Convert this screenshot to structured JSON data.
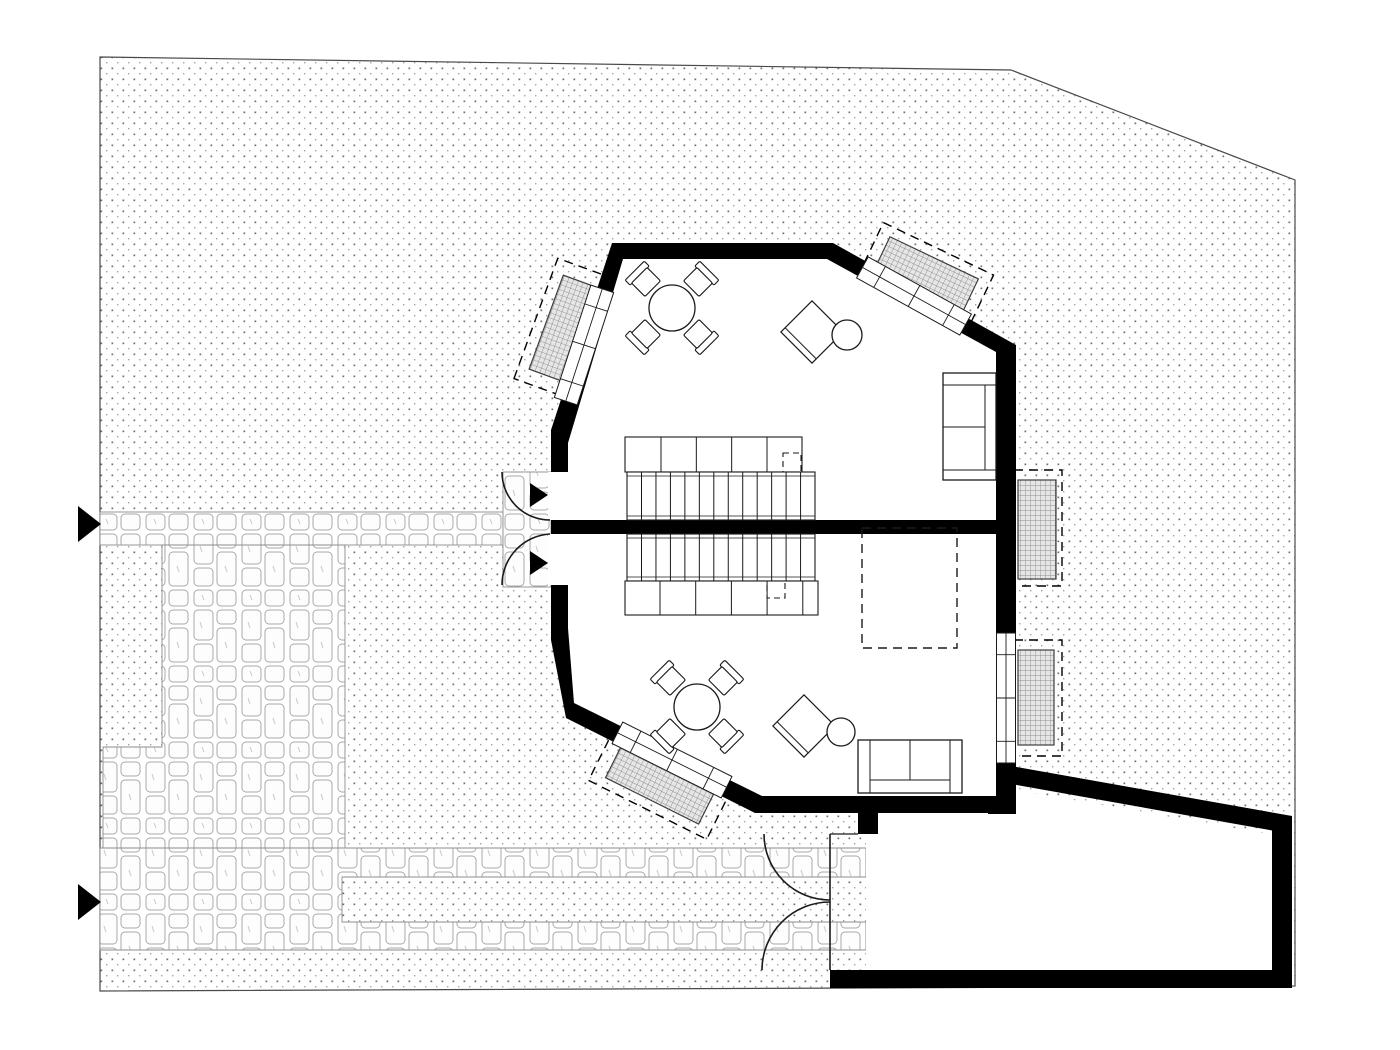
{
  "document": {
    "kind": "architectural-site-and-floor-plan",
    "canvas": {
      "width": 1400,
      "height": 1050,
      "background": "#ffffff"
    }
  },
  "colors": {
    "wall": "#000000",
    "line": "#1a1a1a",
    "white": "#ffffff",
    "site_edge": "#4a4a4a",
    "paving_edge": "#8c8c8c",
    "grate_edge": "#3c3c3c"
  },
  "defaults": {
    "stroke": "#1a1a1a",
    "sw": 1.2
  },
  "elements": [
    {
      "name": "site-parcel",
      "type": "polygon",
      "pts": [
        [
          100,
          57
        ],
        [
          1011,
          70
        ],
        [
          1295,
          180
        ],
        [
          1295,
          986
        ],
        [
          866,
          988
        ],
        [
          100,
          991
        ]
      ],
      "fill": "url(#stipple)",
      "stroke": "@site_edge",
      "sw": 1.2
    },
    {
      "name": "paving-walkway-upper",
      "type": "rect",
      "x": 100,
      "y": 512,
      "w": 403,
      "h": 33,
      "fill": "url(#stone)",
      "stroke": "@paving_edge",
      "sw": 0.9
    },
    {
      "name": "paving-entry-pad",
      "type": "rect",
      "x": 503,
      "y": 472,
      "w": 48,
      "h": 115,
      "fill": "url(#stone)",
      "stroke": "@paving_edge",
      "sw": 0.9
    },
    {
      "name": "paving-courtyard",
      "type": "polygon",
      "pts": [
        [
          162,
          545
        ],
        [
          345,
          545
        ],
        [
          345,
          848
        ],
        [
          103,
          848
        ],
        [
          103,
          747
        ],
        [
          162,
          747
        ]
      ],
      "fill": "url(#stone)",
      "stroke": "@paving_edge",
      "sw": 0.9
    },
    {
      "name": "paving-walkway-lower",
      "type": "polygon",
      "pts": [
        [
          100,
          848
        ],
        [
          866,
          848
        ],
        [
          866,
          877
        ],
        [
          342,
          877
        ],
        [
          342,
          922
        ],
        [
          866,
          922
        ],
        [
          866,
          950
        ],
        [
          100,
          950
        ]
      ],
      "fill": "url(#stone)",
      "stroke": "@paving_edge",
      "sw": 0.9
    },
    {
      "name": "lightwell-topleft-dashed-outline",
      "type": "rect",
      "x": 501,
      "y": 298,
      "w": 128,
      "h": 62,
      "rot": -70,
      "fill": "none",
      "stroke": "@wall",
      "sw": 1.4,
      "dash": "9 6"
    },
    {
      "name": "lightwell-topleft-grate",
      "type": "rect",
      "x": 515,
      "y": 309,
      "w": 100,
      "h": 40,
      "rot": -70,
      "fill": "url(#grate)",
      "stroke": "@grate_edge",
      "sw": 1.2
    },
    {
      "name": "lightwell-topright-dashed-outline",
      "type": "rect",
      "x": 865,
      "y": 246,
      "w": 122,
      "h": 58,
      "rot": 25.5,
      "fill": "none",
      "stroke": "@wall",
      "sw": 1.4,
      "dash": "9 6"
    },
    {
      "name": "lightwell-topright-grate",
      "type": "rect",
      "x": 877,
      "y": 256,
      "w": 98,
      "h": 38,
      "rot": 25.5,
      "fill": "url(#grate)",
      "stroke": "@grate_edge",
      "sw": 1.2
    },
    {
      "name": "lightwell-right-upper-dashed-outline",
      "type": "rect",
      "x": 1014,
      "y": 470,
      "w": 48,
      "h": 116,
      "fill": "none",
      "stroke": "@wall",
      "sw": 1.4,
      "dash": "9 6"
    },
    {
      "name": "lightwell-right-upper-grate",
      "type": "rect",
      "x": 1018,
      "y": 480,
      "w": 38,
      "h": 99,
      "fill": "url(#grate)",
      "stroke": "@grate_edge",
      "sw": 1.2
    },
    {
      "name": "lightwell-right-lower-dashed-outline",
      "type": "rect",
      "x": 1014,
      "y": 640,
      "w": 48,
      "h": 116,
      "fill": "none",
      "stroke": "@wall",
      "sw": 1.4,
      "dash": "9 6"
    },
    {
      "name": "lightwell-right-lower-grate",
      "type": "rect",
      "x": 1018,
      "y": 650,
      "w": 36,
      "h": 95,
      "fill": "url(#grate)",
      "stroke": "@grate_edge",
      "sw": 1.2
    },
    {
      "name": "lightwell-bottomleft-dashed-outline",
      "type": "rect",
      "x": 595,
      "y": 753,
      "w": 132,
      "h": 60,
      "rot": 26.5,
      "fill": "none",
      "stroke": "@wall",
      "sw": 1.4,
      "dash": "9 6"
    },
    {
      "name": "lightwell-bottomleft-grate",
      "type": "rect",
      "x": 609,
      "y": 763,
      "w": 104,
      "h": 40,
      "rot": 26.5,
      "fill": "url(#grate)",
      "stroke": "@grate_edge",
      "sw": 1.2
    },
    {
      "name": "garage-interior",
      "type": "polygon",
      "pts": [
        [
          866,
          813
        ],
        [
          1004,
          813
        ],
        [
          1004,
          788
        ],
        [
          1270,
          834
        ],
        [
          1270,
          970
        ],
        [
          866,
          970
        ]
      ],
      "fill": "@white",
      "stroke": "none"
    },
    {
      "name": "garage-wall-top",
      "type": "polygon",
      "pts": [
        [
          1000,
          764
        ],
        [
          1292,
          816
        ],
        [
          1292,
          834
        ],
        [
          1000,
          782
        ]
      ],
      "fill": "@wall",
      "stroke": "none"
    },
    {
      "name": "garage-wall-right",
      "type": "rect",
      "x": 1272,
      "y": 816,
      "w": 20,
      "h": 172,
      "fill": "@wall",
      "stroke": "none"
    },
    {
      "name": "garage-wall-bottom",
      "type": "rect",
      "x": 830,
      "y": 970,
      "w": 462,
      "h": 18,
      "fill": "@wall",
      "stroke": "none"
    },
    {
      "name": "garage-wall-left-stub",
      "type": "rect",
      "x": 858,
      "y": 798,
      "w": 20,
      "h": 36,
      "fill": "@wall",
      "stroke": "none"
    },
    {
      "name": "garage-door-leaf-line",
      "type": "line",
      "x1": 830,
      "y1": 834,
      "x2": 830,
      "y2": 970,
      "sw": 1.6
    },
    {
      "name": "garage-door-jamb-upper",
      "type": "line",
      "x1": 830,
      "y1": 834,
      "x2": 858,
      "y2": 834,
      "sw": 1.2
    },
    {
      "name": "garage-door-swing-upper",
      "type": "path",
      "d": "M 764 834 A 66 66 0 0 0 830 900",
      "fill": "none",
      "sw": 1.6
    },
    {
      "name": "garage-door-swing-lower",
      "type": "path",
      "d": "M 762 970 A 68 68 0 0 1 830 902",
      "fill": "none",
      "sw": 1.6
    },
    {
      "name": "house-step-wall",
      "type": "rect",
      "x": 988,
      "y": 762,
      "w": 28,
      "h": 52,
      "fill": "@wall",
      "stroke": "none"
    },
    {
      "name": "house-exterior-walls",
      "type": "polygon",
      "pts": [
        [
          612,
          243
        ],
        [
          833,
          243
        ],
        [
          1016,
          345
        ],
        [
          1016,
          813
        ],
        [
          755,
          813
        ],
        [
          566,
          718
        ],
        [
          551,
          640
        ],
        [
          551,
          430
        ]
      ],
      "fill": "@wall",
      "stroke": "none"
    },
    {
      "name": "house-interior-floor",
      "type": "polygon",
      "pts": [
        [
          623,
          259
        ],
        [
          827,
          259
        ],
        [
          996,
          352
        ],
        [
          996,
          796
        ],
        [
          762,
          796
        ],
        [
          574,
          703
        ],
        [
          568,
          628
        ],
        [
          568,
          443
        ]
      ],
      "fill": "@white",
      "stroke": "none"
    },
    {
      "name": "wall-central-divider",
      "type": "rect",
      "x": 551,
      "y": 520,
      "w": 465,
      "h": 14,
      "fill": "@wall",
      "stroke": "none"
    },
    {
      "name": "door-opening-upper",
      "type": "rect",
      "x": 548,
      "y": 472,
      "w": 22,
      "h": 48,
      "fill": "@white",
      "stroke": "none"
    },
    {
      "name": "door-opening-lower",
      "type": "rect",
      "x": 548,
      "y": 534,
      "w": 22,
      "h": 51,
      "fill": "@white",
      "stroke": "none"
    },
    {
      "name": "window-topleft",
      "type": "window",
      "cx": 584,
      "cy": 345,
      "len": 118,
      "wid": 24,
      "rot": -72
    },
    {
      "name": "window-topright",
      "type": "window",
      "cx": 914,
      "cy": 296,
      "len": 118,
      "wid": 24,
      "rot": 29
    },
    {
      "name": "window-right",
      "type": "window",
      "cx": 1006,
      "cy": 698,
      "len": 130,
      "wid": 19,
      "rot": 90
    },
    {
      "name": "window-bottomleft",
      "type": "window",
      "cx": 672,
      "cy": 760,
      "len": 122,
      "wid": 24,
      "rot": 26.5
    },
    {
      "name": "entry-door-swing-upper",
      "type": "path",
      "d": "M 502 472 A 48 48 0 0 0 550 520",
      "fill": "none",
      "sw": 1.6
    },
    {
      "name": "entry-door-swing-lower",
      "type": "path",
      "d": "M 502 585 A 51 51 0 0 1 550 534",
      "fill": "none",
      "sw": 1.6
    },
    {
      "name": "entry-arrow-upper",
      "type": "polygon",
      "pts": [
        [
          530,
          483
        ],
        [
          548,
          495
        ],
        [
          530,
          507
        ]
      ],
      "fill": "@wall",
      "stroke": "none"
    },
    {
      "name": "entry-arrow-lower",
      "type": "polygon",
      "pts": [
        [
          530,
          551
        ],
        [
          548,
          563
        ],
        [
          530,
          575
        ]
      ],
      "fill": "@wall",
      "stroke": "none"
    },
    {
      "name": "site-access-arrow-upper",
      "type": "polygon",
      "pts": [
        [
          78,
          506
        ],
        [
          101,
          524
        ],
        [
          78,
          542
        ]
      ],
      "fill": "@wall",
      "stroke": "none"
    },
    {
      "name": "site-access-arrow-lower",
      "type": "polygon",
      "pts": [
        [
          78,
          884
        ],
        [
          101,
          902
        ],
        [
          78,
          920
        ]
      ],
      "fill": "@wall",
      "stroke": "none"
    },
    {
      "name": "closet-upper",
      "type": "rect",
      "x": 625,
      "y": 437,
      "w": 177,
      "h": 35,
      "fill": "@white",
      "sw": 1.1
    },
    {
      "name": "closet-upper-dividers",
      "type": "vlines",
      "x0": 661,
      "dx": 35.33,
      "n": 4,
      "y": 437,
      "h": 35,
      "sw": 1
    },
    {
      "name": "closet-upper-dashed-box",
      "type": "rect",
      "x": 783,
      "y": 453,
      "w": 18,
      "h": 19,
      "fill": "none",
      "sw": 1.1,
      "dash": "6 4"
    },
    {
      "name": "stairs-upper",
      "type": "rect",
      "x": 627,
      "y": 472,
      "w": 188,
      "h": 48,
      "fill": "@white",
      "sw": 1.1
    },
    {
      "name": "stairs-upper-treads",
      "type": "vlines",
      "x0": 641.5,
      "dx": 14.46,
      "n": 12,
      "y": 472,
      "h": 48,
      "sw": 1
    },
    {
      "name": "stairs-upper-stringers",
      "type": "hlines",
      "y0": 476,
      "dy": 40,
      "n": 2,
      "x": 627,
      "w": 188,
      "sw": 0.8
    },
    {
      "name": "stairs-lower",
      "type": "rect",
      "x": 627,
      "y": 534,
      "w": 188,
      "h": 47,
      "fill": "@white",
      "sw": 1.1
    },
    {
      "name": "stairs-lower-treads",
      "type": "vlines",
      "x0": 641.5,
      "dx": 14.46,
      "n": 12,
      "y": 534,
      "h": 47,
      "sw": 1
    },
    {
      "name": "stairs-lower-stringers",
      "type": "hlines",
      "y0": 538,
      "dy": 39,
      "n": 2,
      "x": 627,
      "w": 188,
      "sw": 0.8
    },
    {
      "name": "closet-lower",
      "type": "rect",
      "x": 625,
      "y": 581,
      "w": 193,
      "h": 34,
      "fill": "@white",
      "sw": 1.1
    },
    {
      "name": "closet-lower-dividers",
      "type": "vlines",
      "x0": 660,
      "dx": 35.7,
      "n": 5,
      "y": 581,
      "h": 34,
      "sw": 1
    },
    {
      "name": "closet-lower-dashed-box",
      "type": "rect",
      "x": 767,
      "y": 581,
      "w": 18,
      "h": 17,
      "fill": "none",
      "sw": 1.1,
      "dash": "6 4"
    },
    {
      "name": "void-dashed-outline",
      "type": "rect",
      "x": 862,
      "y": 528,
      "w": 95,
      "h": 120,
      "fill": "none",
      "sw": 1.4,
      "dash": "9 6"
    },
    {
      "name": "dining-chair",
      "type": "chair",
      "x": 646,
      "y": 282,
      "rot": -45
    },
    {
      "name": "dining-chair",
      "type": "chair",
      "x": 698,
      "y": 282,
      "rot": 45
    },
    {
      "name": "dining-chair",
      "type": "chair",
      "x": 646,
      "y": 334,
      "rot": -135
    },
    {
      "name": "dining-chair",
      "type": "chair",
      "x": 698,
      "y": 334,
      "rot": 135
    },
    {
      "name": "dining-table-upper",
      "type": "circle",
      "cx": 672,
      "cy": 308,
      "r": 23,
      "fill": "@white",
      "sw": 1.3
    },
    {
      "name": "lounge-chair-upper",
      "type": "lounge",
      "x": 812,
      "y": 332,
      "rot": 45,
      "size": 44
    },
    {
      "name": "side-table-upper",
      "type": "circle",
      "cx": 847,
      "cy": 335,
      "r": 15,
      "fill": "@white",
      "sw": 1.3
    },
    {
      "name": "sofa-upper-outline",
      "type": "rect",
      "x": 943,
      "y": 373,
      "w": 53,
      "h": 107,
      "fill": "@white",
      "sw": 1.3
    },
    {
      "name": "sofa-upper-arm-top",
      "type": "line",
      "x1": 943,
      "y1": 385,
      "x2": 996,
      "y2": 385,
      "sw": 1
    },
    {
      "name": "sofa-upper-arm-bottom",
      "type": "line",
      "x1": 943,
      "y1": 470,
      "x2": 996,
      "y2": 470,
      "sw": 1
    },
    {
      "name": "sofa-upper-back",
      "type": "line",
      "x1": 985,
      "y1": 385,
      "x2": 985,
      "y2": 470,
      "sw": 1
    },
    {
      "name": "sofa-upper-cushion-divider",
      "type": "line",
      "x1": 943,
      "y1": 427,
      "x2": 985,
      "y2": 427,
      "sw": 1
    },
    {
      "name": "dining-chair",
      "type": "chair",
      "x": 671,
      "y": 681,
      "rot": -45
    },
    {
      "name": "dining-chair",
      "type": "chair",
      "x": 723,
      "y": 681,
      "rot": 45
    },
    {
      "name": "dining-chair",
      "type": "chair",
      "x": 671,
      "y": 733,
      "rot": -135
    },
    {
      "name": "dining-chair",
      "type": "chair",
      "x": 723,
      "y": 733,
      "rot": 135
    },
    {
      "name": "dining-table-lower",
      "type": "circle",
      "cx": 697,
      "cy": 707,
      "r": 23,
      "fill": "@white",
      "sw": 1.3
    },
    {
      "name": "lounge-chair-lower",
      "type": "lounge",
      "x": 804,
      "y": 726,
      "rot": 45,
      "size": 44
    },
    {
      "name": "side-table-lower",
      "type": "circle",
      "cx": 841,
      "cy": 732,
      "r": 14,
      "fill": "@white",
      "sw": 1.3
    },
    {
      "name": "sofa-lower-outline",
      "type": "rect",
      "x": 858,
      "y": 740,
      "w": 104,
      "h": 53,
      "fill": "@white",
      "sw": 1.3
    },
    {
      "name": "sofa-lower-arm-left",
      "type": "line",
      "x1": 870,
      "y1": 740,
      "x2": 870,
      "y2": 793,
      "sw": 1
    },
    {
      "name": "sofa-lower-arm-right",
      "type": "line",
      "x1": 950,
      "y1": 740,
      "x2": 950,
      "y2": 793,
      "sw": 1
    },
    {
      "name": "sofa-lower-back",
      "type": "line",
      "x1": 870,
      "y1": 780,
      "x2": 950,
      "y2": 780,
      "sw": 1
    },
    {
      "name": "sofa-lower-cushion-divider",
      "type": "line",
      "x1": 910,
      "y1": 740,
      "x2": 910,
      "y2": 780,
      "sw": 1
    }
  ]
}
